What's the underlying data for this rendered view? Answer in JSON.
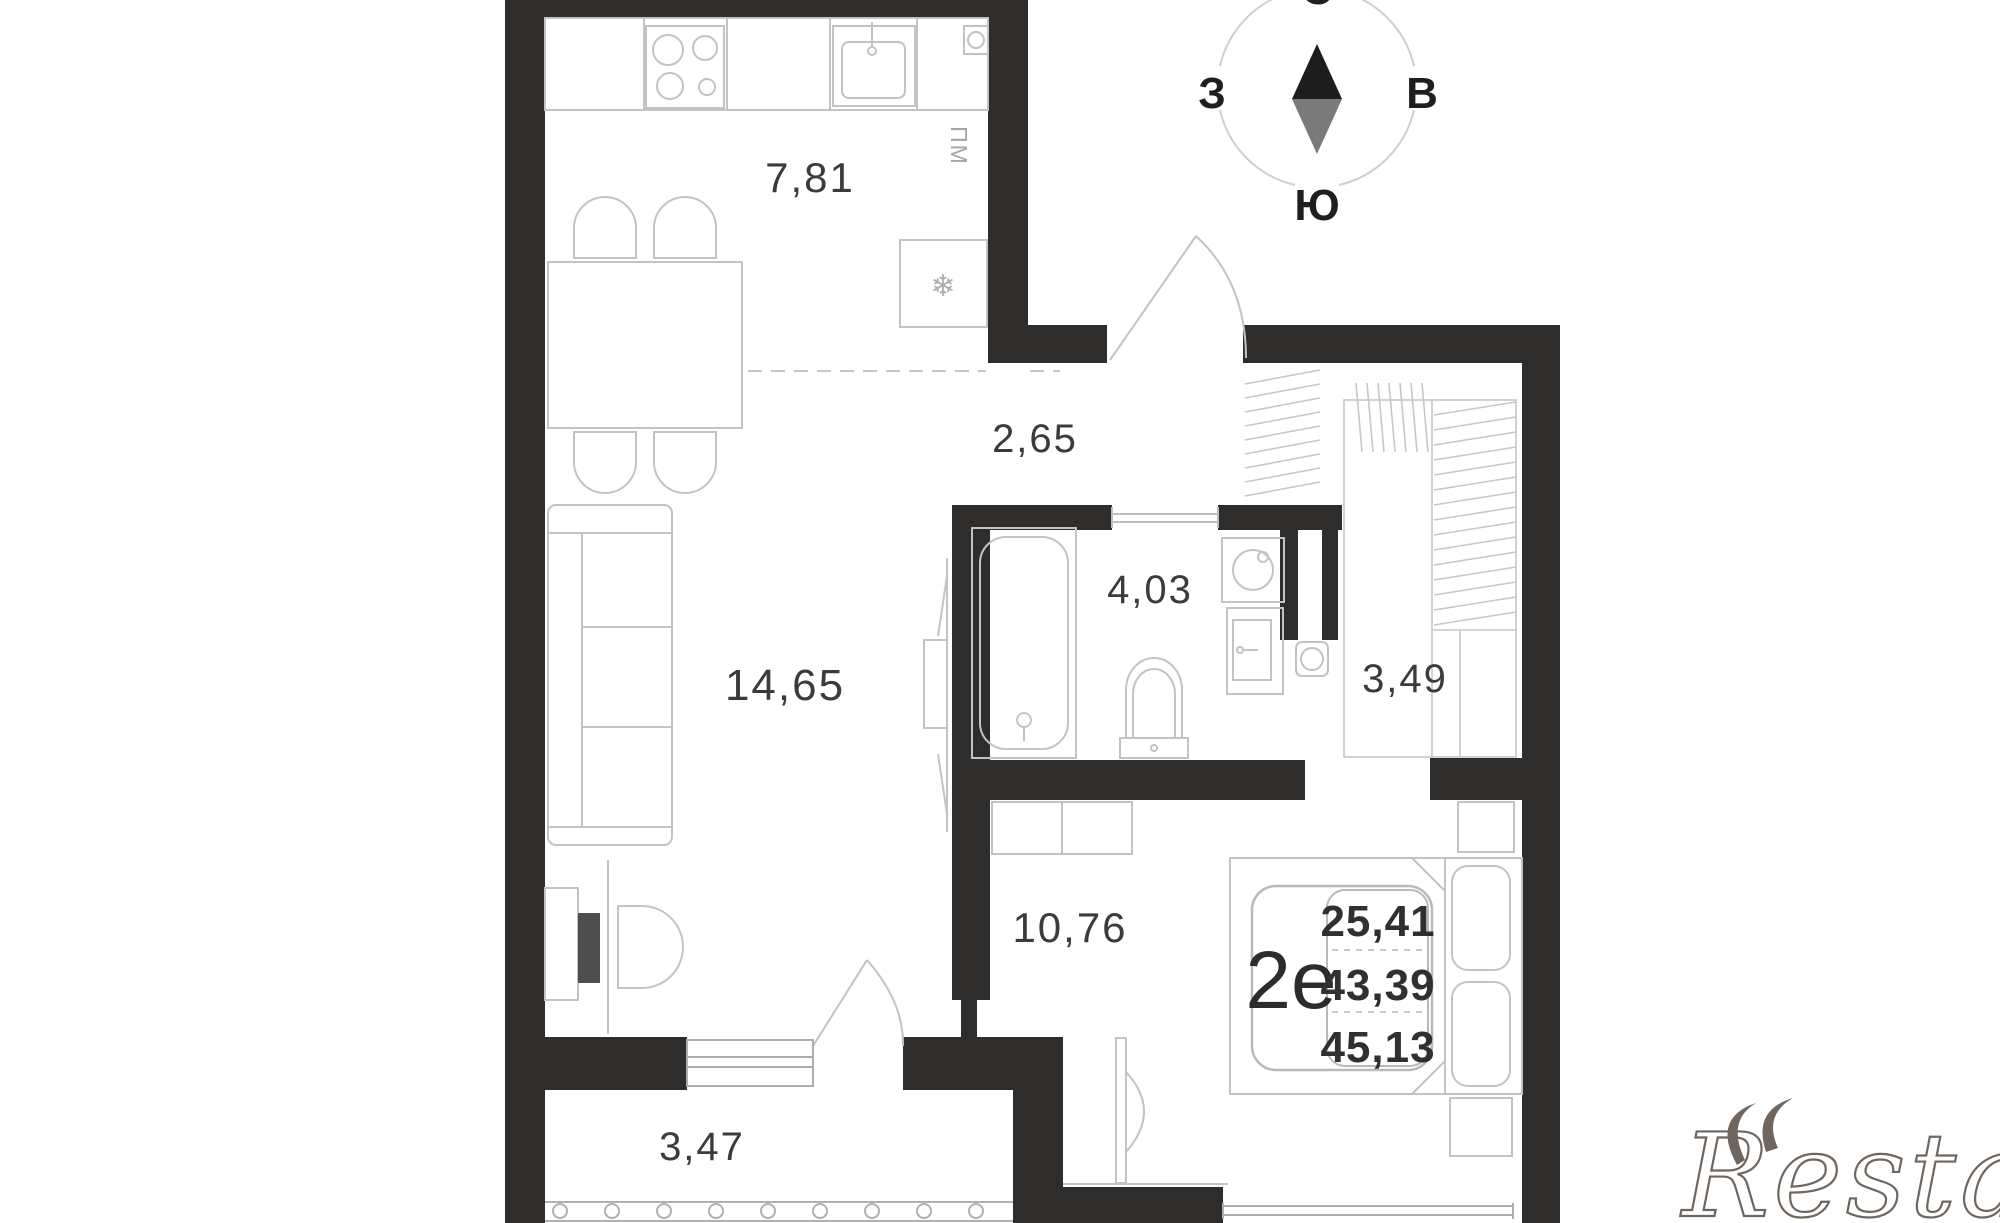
{
  "rooms": {
    "kitchen": {
      "area": "7,81"
    },
    "hallway": {
      "area": "2,65"
    },
    "bathroom": {
      "area": "4,03"
    },
    "wardrobe": {
      "area": "3,49"
    },
    "living_room": {
      "area": "14,65"
    },
    "bedroom": {
      "area": "10,76"
    },
    "balcony": {
      "area": "3,47"
    }
  },
  "unit_badge": {
    "unit_type": "2е",
    "values": [
      "25,41",
      "43,39",
      "45,13"
    ]
  },
  "compass": {
    "north": "С",
    "south": "Ю",
    "west": "З",
    "east": "В"
  },
  "labels": {
    "dishwasher": "ПМ"
  },
  "icons": {
    "fridge_snowflake": "❄"
  },
  "watermark": "Restate",
  "colors": {
    "wall": "#2e2d2c",
    "furniture_line": "#c3c3c3",
    "label_text": "#3b3b3b",
    "needle_north": "#1d1d1d",
    "needle_south": "#7a7a7a",
    "watermark_stroke": "#6f675f"
  }
}
